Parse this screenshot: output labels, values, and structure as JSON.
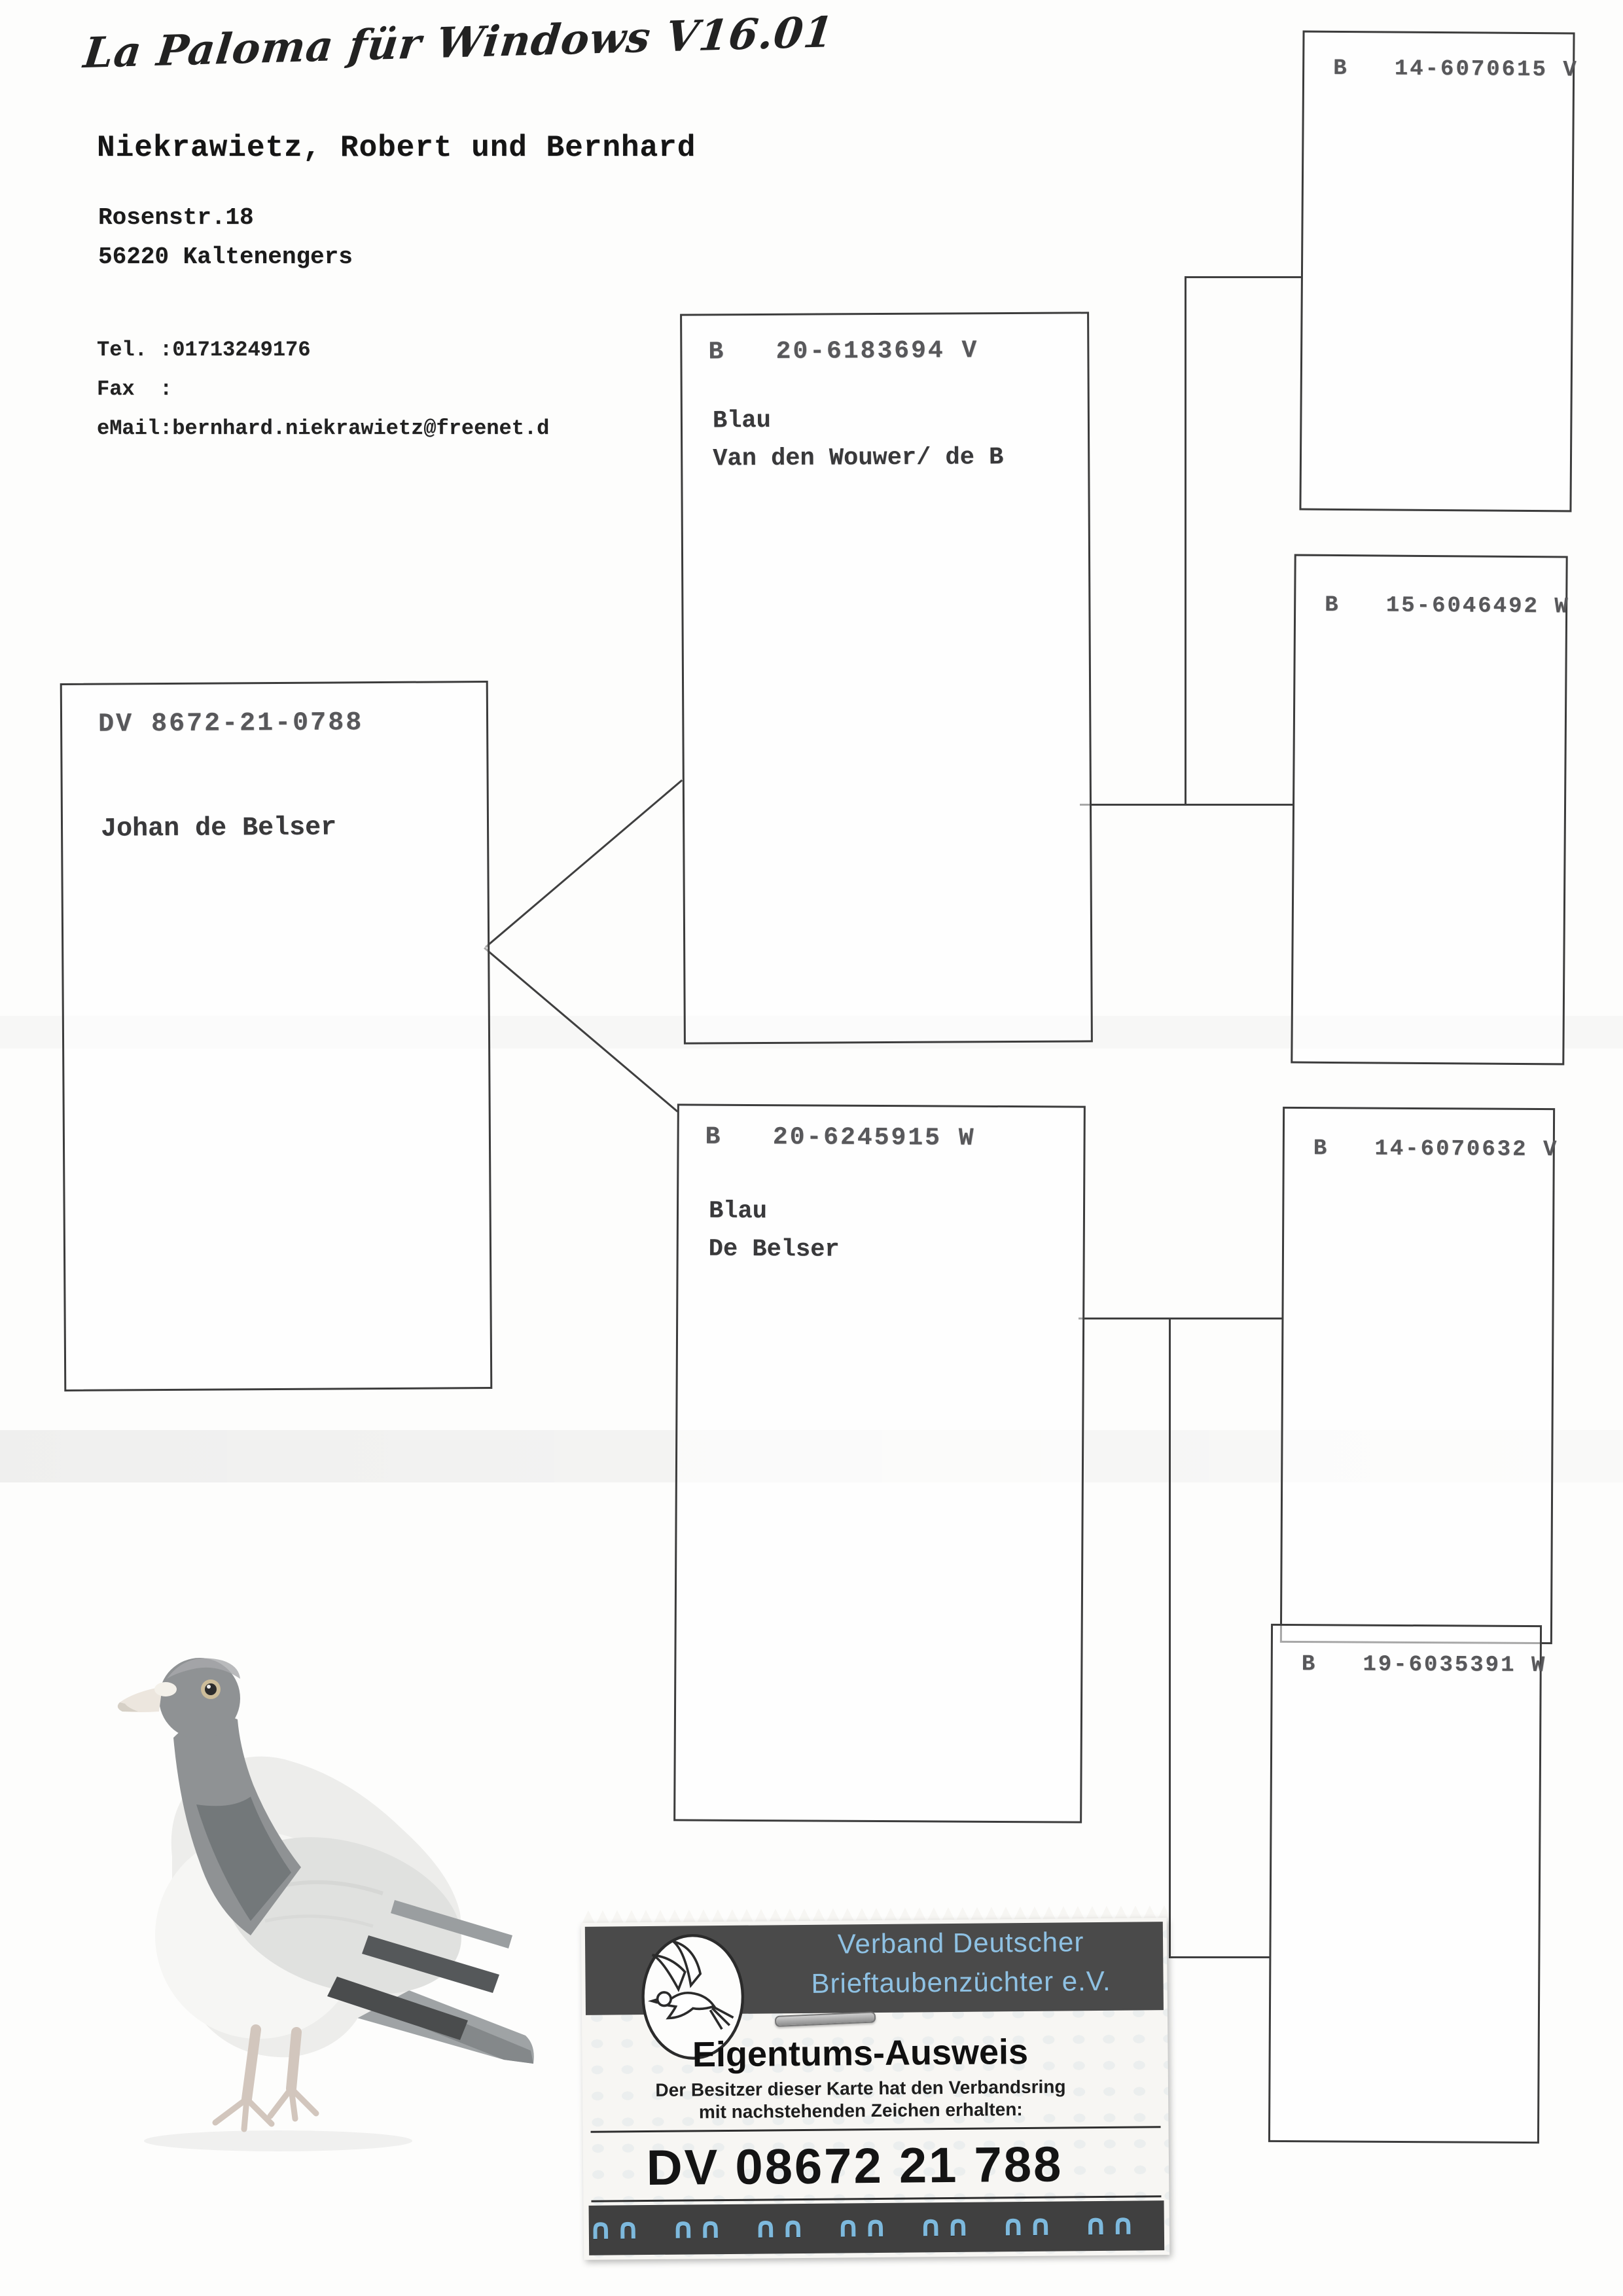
{
  "page": {
    "app_title": "La Paloma für Windows V16.01"
  },
  "owner": {
    "name": "Niekrawietz, Robert und Bernhard",
    "street": "Rosenstr.18",
    "city": "56220 Kaltenengers",
    "tel": "Tel. :01713249176",
    "fax": "Fax  :",
    "email": "eMail:bernhard.niekrawietz@freenet.d"
  },
  "pedigree": {
    "subject": {
      "ring": "DV 8672-21-0788",
      "name": "Johan de Belser"
    },
    "sire": {
      "ring": "B   20-6183694 V",
      "color": "Blau",
      "strain": "Van den Wouwer/ de B"
    },
    "dam": {
      "ring": "B   20-6245915 W",
      "color": "Blau",
      "strain": "De Belser"
    },
    "grandparents": [
      {
        "ring": "B   14-6070615 V"
      },
      {
        "ring": "B   15-6046492 W"
      },
      {
        "ring": "B   14-6070632 V"
      },
      {
        "ring": "B   19-6035391 W"
      }
    ]
  },
  "stamp": {
    "org_line1": "Verband Deutscher",
    "org_line2": "Brieftaubenzüchter e.V.",
    "title": "Eigentums-Ausweis",
    "subtitle_line1": "Der Besitzer dieser Karte hat den Verbandsring",
    "subtitle_line2": "mit nachstehenden Zeichen erhalten:",
    "ring_number": "DV 08672 21 788",
    "decor_pattern": "∩∩  ∩∩  ∩∩  ∩∩  ∩∩  ∩∩  ∩∩  ∩∩  ∩∩  ∩∩",
    "colors": {
      "band": "#4a4a4a",
      "accent_blue": "#8ec1e3",
      "decor_blue": "#7db9dd"
    }
  }
}
